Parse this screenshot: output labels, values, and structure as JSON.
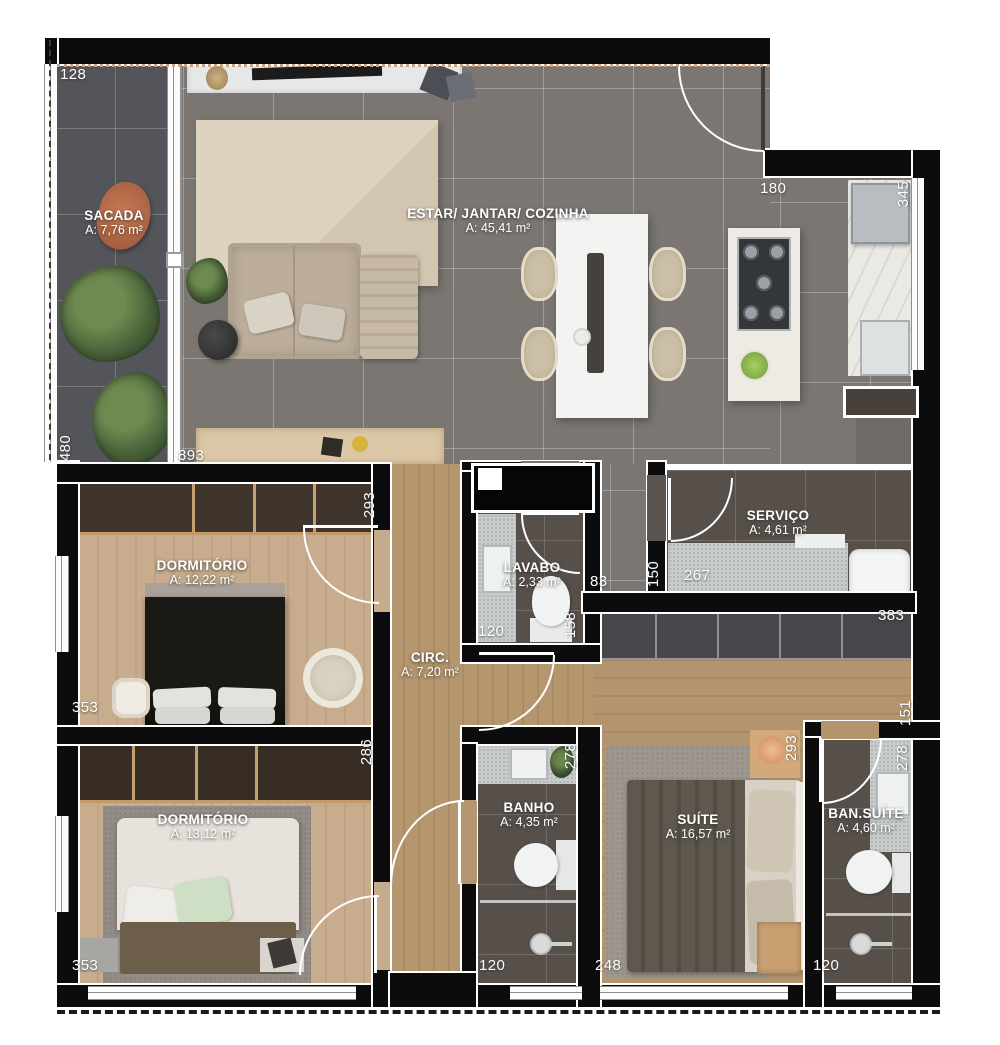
{
  "plan_title": "Apartment floor plan",
  "rooms": {
    "sacada": {
      "name": "SACADA",
      "area": "A: 7,76 m²"
    },
    "estar": {
      "name": "ESTAR/ JANTAR/ COZINHA",
      "area": "A: 45,41 m²"
    },
    "dorm1": {
      "name": "DORMITÓRIO",
      "area": "A: 12,22 m²"
    },
    "lavabo": {
      "name": "LAVABO",
      "area": "A: 2,33 m²"
    },
    "servico": {
      "name": "SERVIÇO",
      "area": "A: 4,61 m²"
    },
    "circ": {
      "name": "CIRC.",
      "area": "A: 7,20 m²"
    },
    "dorm2": {
      "name": "DORMITÓRIO",
      "area": "A: 13,12 m²"
    },
    "banho": {
      "name": "BANHO",
      "area": "A: 4,35 m²"
    },
    "suite": {
      "name": "SUÍTE",
      "area": "A: 16,57 m²"
    },
    "bansuite": {
      "name": "BAN.SUÍTE",
      "area": "A: 4,60 m²"
    }
  },
  "dims": {
    "sacada_width": "128",
    "kitchen_recess": "180",
    "kitchen_depth": "345",
    "sacada_height": "480",
    "living_width": "893",
    "dorm1_depth": "293",
    "dorm1_width": "353",
    "lavabo_width": "120",
    "lavabo_depth": "158",
    "shaft_gap": "83",
    "servico_left": "150",
    "servico_width": "267",
    "suite_closet": "383",
    "hall_width": "151",
    "dorm2_depth": "286",
    "banho_depth": "278",
    "suite_depth": "293",
    "bansuite_depth": "278",
    "dorm2_width": "353",
    "banho_width": "120",
    "suite_width": "248",
    "bansuite_width": "120"
  },
  "colors": {
    "wall": "#0c0c0c",
    "balcony_tile": "#54555a",
    "living_tile": "#7b7672",
    "bedroom_wood": "#c7ac8d",
    "corridor_wood": "#b5976f",
    "bath_floor": "#57504a",
    "label_text": "#ffffff",
    "wardrobe_dark": "#3b3128",
    "suite_closet_gray": "#46474b"
  }
}
